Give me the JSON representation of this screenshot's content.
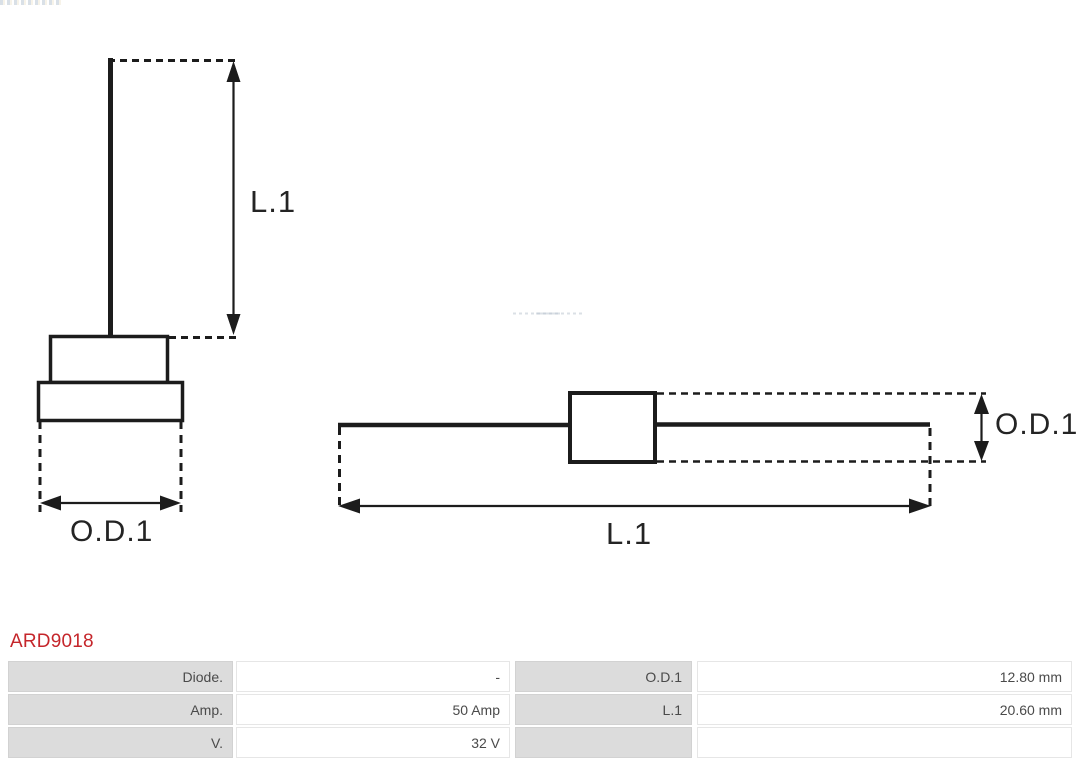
{
  "product": {
    "part_number": "ARD9018"
  },
  "colors": {
    "accent_red": "#c5262b",
    "line_black": "#1c1c1c",
    "cell_gray": "#dcdcdc",
    "table_text": "#4a4a4a"
  },
  "diagram": {
    "left_figure": {
      "length_label": "L.1",
      "diameter_label": "O.D.1"
    },
    "right_figure": {
      "length_label": "L.1",
      "diameter_label": "O.D.1"
    }
  },
  "specs_table": {
    "rows": [
      {
        "label_left": "Diode.",
        "value_left": "-",
        "label_right": "O.D.1",
        "value_right": "12.80 mm"
      },
      {
        "label_left": "Amp.",
        "value_left": "50 Amp",
        "label_right": "L.1",
        "value_right": "20.60 mm"
      },
      {
        "label_left": "V.",
        "value_left": "32 V",
        "label_right": "",
        "value_right": ""
      }
    ]
  }
}
